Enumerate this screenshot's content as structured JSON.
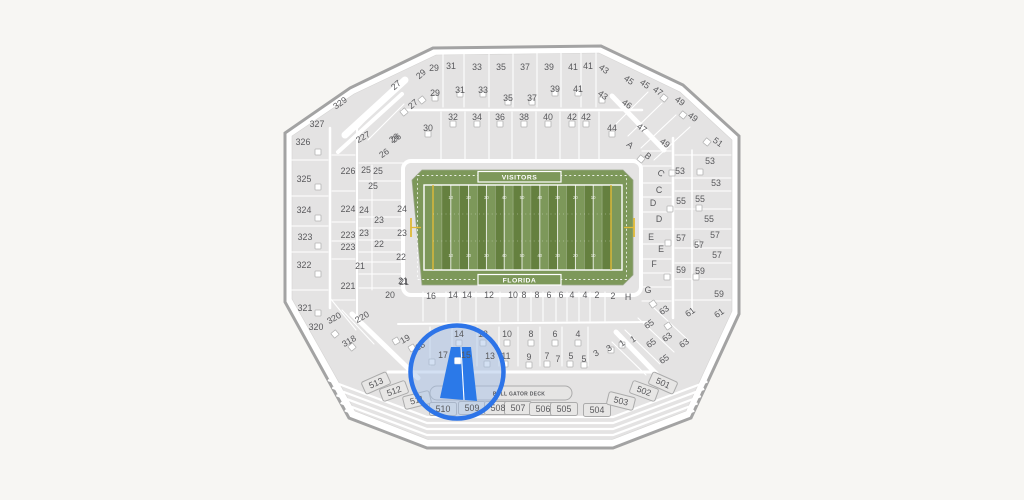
{
  "map": {
    "type": "stadium-seating-map",
    "field": {
      "top_label": "VISITORS",
      "bottom_label": "FLORIDA",
      "yard_numbers": [
        "10",
        "20",
        "30",
        "40",
        "50",
        "40",
        "30",
        "20",
        "10"
      ]
    },
    "deck_label": "BULL GATOR DECK",
    "selected_section": "15",
    "colors": {
      "background": "#f7f6f3",
      "section_fill": "#e4e3e3",
      "section_line": "#ffffff",
      "shell_border": "#a3a3a3",
      "label": "#58585b",
      "field_green_light": "#7d985a",
      "field_green_dark": "#65803f",
      "field_line": "#ffffff",
      "goal_yellow": "#e0ba38",
      "highlight_blue": "#2b79e8",
      "highlight_ring": "#2d74e8",
      "highlight_tint": "#a8c2e8",
      "box_fill": "#e7e6e5",
      "box_border": "#ababab"
    },
    "section_labels": [
      [
        "29",
        434,
        68
      ],
      [
        "31",
        451,
        66
      ],
      [
        "33",
        477,
        67
      ],
      [
        "35",
        501,
        67
      ],
      [
        "37",
        525,
        67
      ],
      [
        "39",
        549,
        67
      ],
      [
        "41",
        573,
        67
      ],
      [
        "41",
        588,
        66
      ],
      [
        "43",
        604,
        69,
        35
      ],
      [
        "29",
        421,
        74,
        -40
      ],
      [
        "27",
        396,
        85,
        -40
      ],
      [
        "29",
        435,
        93
      ],
      [
        "27",
        413,
        104,
        -40
      ],
      [
        "31",
        460,
        90
      ],
      [
        "33",
        483,
        90
      ],
      [
        "35",
        508,
        98
      ],
      [
        "37",
        532,
        98
      ],
      [
        "39",
        555,
        89
      ],
      [
        "41",
        578,
        89
      ],
      [
        "43",
        603,
        95,
        35
      ],
      [
        "45",
        629,
        80,
        35
      ],
      [
        "45",
        645,
        84,
        35
      ],
      [
        "47",
        658,
        91,
        35
      ],
      [
        "49",
        680,
        101,
        35
      ],
      [
        "49",
        693,
        117,
        35
      ],
      [
        "46",
        627,
        104,
        35
      ],
      [
        "47",
        642,
        128,
        35
      ],
      [
        "49",
        665,
        143,
        35
      ],
      [
        "51",
        718,
        142,
        35
      ],
      [
        "44",
        612,
        128
      ],
      [
        "42",
        586,
        117
      ],
      [
        "42",
        572,
        117
      ],
      [
        "40",
        548,
        117
      ],
      [
        "38",
        524,
        117
      ],
      [
        "36",
        500,
        117
      ],
      [
        "34",
        477,
        117
      ],
      [
        "32",
        453,
        117
      ],
      [
        "30",
        428,
        128
      ],
      [
        "26",
        396,
        138,
        -35
      ],
      [
        "329",
        340,
        103,
        -35
      ],
      [
        "327",
        317,
        124
      ],
      [
        "326",
        303,
        142
      ],
      [
        "325",
        304,
        179
      ],
      [
        "324",
        304,
        210
      ],
      [
        "323",
        305,
        237
      ],
      [
        "322",
        304,
        265
      ],
      [
        "321",
        305,
        308
      ],
      [
        "320",
        334,
        318,
        -30
      ],
      [
        "320",
        316,
        327
      ],
      [
        "318",
        349,
        341,
        -30
      ],
      [
        "227",
        363,
        137,
        -30
      ],
      [
        "26",
        394,
        138,
        -35
      ],
      [
        "26",
        384,
        153,
        -35
      ],
      [
        "226",
        348,
        171
      ],
      [
        "25",
        366,
        170
      ],
      [
        "25",
        378,
        171
      ],
      [
        "25",
        373,
        186
      ],
      [
        "224",
        348,
        209
      ],
      [
        "24",
        364,
        210
      ],
      [
        "24",
        402,
        209
      ],
      [
        "23",
        379,
        220
      ],
      [
        "223",
        348,
        235
      ],
      [
        "23",
        364,
        233
      ],
      [
        "23",
        402,
        233
      ],
      [
        "223",
        348,
        247
      ],
      [
        "22",
        379,
        244
      ],
      [
        "22",
        401,
        257
      ],
      [
        "221",
        348,
        286
      ],
      [
        "21",
        360,
        266
      ],
      [
        "21",
        403,
        281
      ],
      [
        "20",
        390,
        295
      ],
      [
        "220",
        362,
        317,
        -30
      ],
      [
        "19",
        405,
        339,
        -30
      ],
      [
        "18",
        420,
        346,
        -30
      ],
      [
        "A",
        630,
        145,
        40
      ],
      [
        "B",
        648,
        156,
        40
      ],
      [
        "C",
        661,
        173,
        40
      ],
      [
        "C",
        659,
        190
      ],
      [
        "D",
        653,
        203
      ],
      [
        "D",
        659,
        219
      ],
      [
        "E",
        651,
        237
      ],
      [
        "E",
        661,
        249
      ],
      [
        "F",
        654,
        264
      ],
      [
        "G",
        648,
        290
      ],
      [
        "H",
        628,
        297
      ],
      [
        "53",
        710,
        161
      ],
      [
        "53",
        680,
        171
      ],
      [
        "53",
        716,
        183
      ],
      [
        "55",
        681,
        201
      ],
      [
        "55",
        700,
        199
      ],
      [
        "55",
        709,
        219
      ],
      [
        "57",
        681,
        238
      ],
      [
        "57",
        715,
        235
      ],
      [
        "57",
        699,
        245
      ],
      [
        "57",
        717,
        255
      ],
      [
        "59",
        681,
        270
      ],
      [
        "59",
        700,
        271
      ],
      [
        "59",
        719,
        294
      ],
      [
        "63",
        664,
        310,
        -35
      ],
      [
        "61",
        690,
        312,
        -35
      ],
      [
        "61",
        719,
        313,
        -35
      ],
      [
        "65",
        649,
        324,
        -35
      ],
      [
        "63",
        667,
        337,
        -35
      ],
      [
        "63",
        684,
        343,
        -35
      ],
      [
        "65",
        651,
        343,
        -35
      ],
      [
        "65",
        664,
        359,
        -35
      ],
      [
        "21",
        404,
        282
      ],
      [
        "16",
        431,
        296
      ],
      [
        "14",
        453,
        295
      ],
      [
        "14",
        467,
        295
      ],
      [
        "12",
        489,
        295
      ],
      [
        "10",
        513,
        295
      ],
      [
        "8",
        524,
        295
      ],
      [
        "8",
        537,
        295
      ],
      [
        "6",
        549,
        295
      ],
      [
        "6",
        561,
        295
      ],
      [
        "4",
        572,
        295
      ],
      [
        "4",
        585,
        295
      ],
      [
        "2",
        597,
        295
      ],
      [
        "2",
        613,
        296
      ],
      [
        "14",
        459,
        334
      ],
      [
        "12",
        483,
        334
      ],
      [
        "10",
        507,
        334
      ],
      [
        "8",
        531,
        334
      ],
      [
        "6",
        555,
        334
      ],
      [
        "4",
        578,
        334
      ],
      [
        "17",
        443,
        355
      ],
      [
        "15",
        466,
        355
      ],
      [
        "13",
        490,
        356
      ],
      [
        "11",
        506,
        356
      ],
      [
        "9",
        529,
        357
      ],
      [
        "7",
        547,
        356
      ],
      [
        "7",
        558,
        359
      ],
      [
        "5",
        571,
        356
      ],
      [
        "5",
        584,
        359
      ],
      [
        "3",
        596,
        353,
        -30
      ],
      [
        "3",
        609,
        348,
        -30
      ],
      [
        "1",
        622,
        343,
        -30
      ],
      [
        "1",
        633,
        339,
        -30
      ],
      [
        "513",
        376,
        383,
        -24
      ],
      [
        "512",
        394,
        391,
        -20
      ],
      [
        "511",
        417,
        400,
        -14
      ],
      [
        "510",
        443,
        409
      ],
      [
        "509",
        472,
        408
      ],
      [
        "508",
        498,
        408
      ],
      [
        "507",
        518,
        408
      ],
      [
        "506",
        543,
        409
      ],
      [
        "505",
        564,
        409
      ],
      [
        "504",
        597,
        410
      ],
      [
        "503",
        621,
        401,
        14
      ],
      [
        "502",
        644,
        391,
        20
      ],
      [
        "501",
        663,
        383,
        24
      ]
    ],
    "tunnels": [
      [
        435,
        98
      ],
      [
        460,
        94
      ],
      [
        483,
        94
      ],
      [
        508,
        102
      ],
      [
        532,
        102
      ],
      [
        555,
        93
      ],
      [
        578,
        93
      ],
      [
        602,
        100
      ],
      [
        428,
        134
      ],
      [
        453,
        124
      ],
      [
        477,
        124
      ],
      [
        500,
        124
      ],
      [
        524,
        124
      ],
      [
        548,
        124
      ],
      [
        572,
        124
      ],
      [
        586,
        124
      ],
      [
        612,
        134
      ],
      [
        318,
        152
      ],
      [
        318,
        187
      ],
      [
        318,
        218
      ],
      [
        318,
        246
      ],
      [
        318,
        274
      ],
      [
        318,
        313
      ],
      [
        672,
        173
      ],
      [
        700,
        172
      ],
      [
        670,
        209
      ],
      [
        699,
        208
      ],
      [
        668,
        243
      ],
      [
        697,
        243
      ],
      [
        667,
        277
      ],
      [
        696,
        277
      ],
      [
        459,
        343
      ],
      [
        483,
        343
      ],
      [
        507,
        343
      ],
      [
        531,
        343
      ],
      [
        555,
        343
      ],
      [
        578,
        343
      ],
      [
        432,
        362
      ],
      [
        487,
        364
      ],
      [
        505,
        364
      ],
      [
        529,
        365
      ],
      [
        547,
        364
      ],
      [
        570,
        364
      ],
      [
        584,
        365
      ],
      [
        664,
        98,
        40
      ],
      [
        683,
        115,
        40
      ],
      [
        707,
        142,
        40
      ],
      [
        641,
        159,
        40
      ],
      [
        404,
        112,
        -40
      ],
      [
        422,
        100,
        -40
      ],
      [
        335,
        334,
        -40
      ],
      [
        352,
        347,
        -40
      ],
      [
        653,
        304,
        -35
      ],
      [
        668,
        326,
        -35
      ],
      [
        611,
        350
      ],
      [
        622,
        345
      ],
      [
        396,
        341,
        -30
      ],
      [
        412,
        348,
        -30
      ]
    ]
  }
}
